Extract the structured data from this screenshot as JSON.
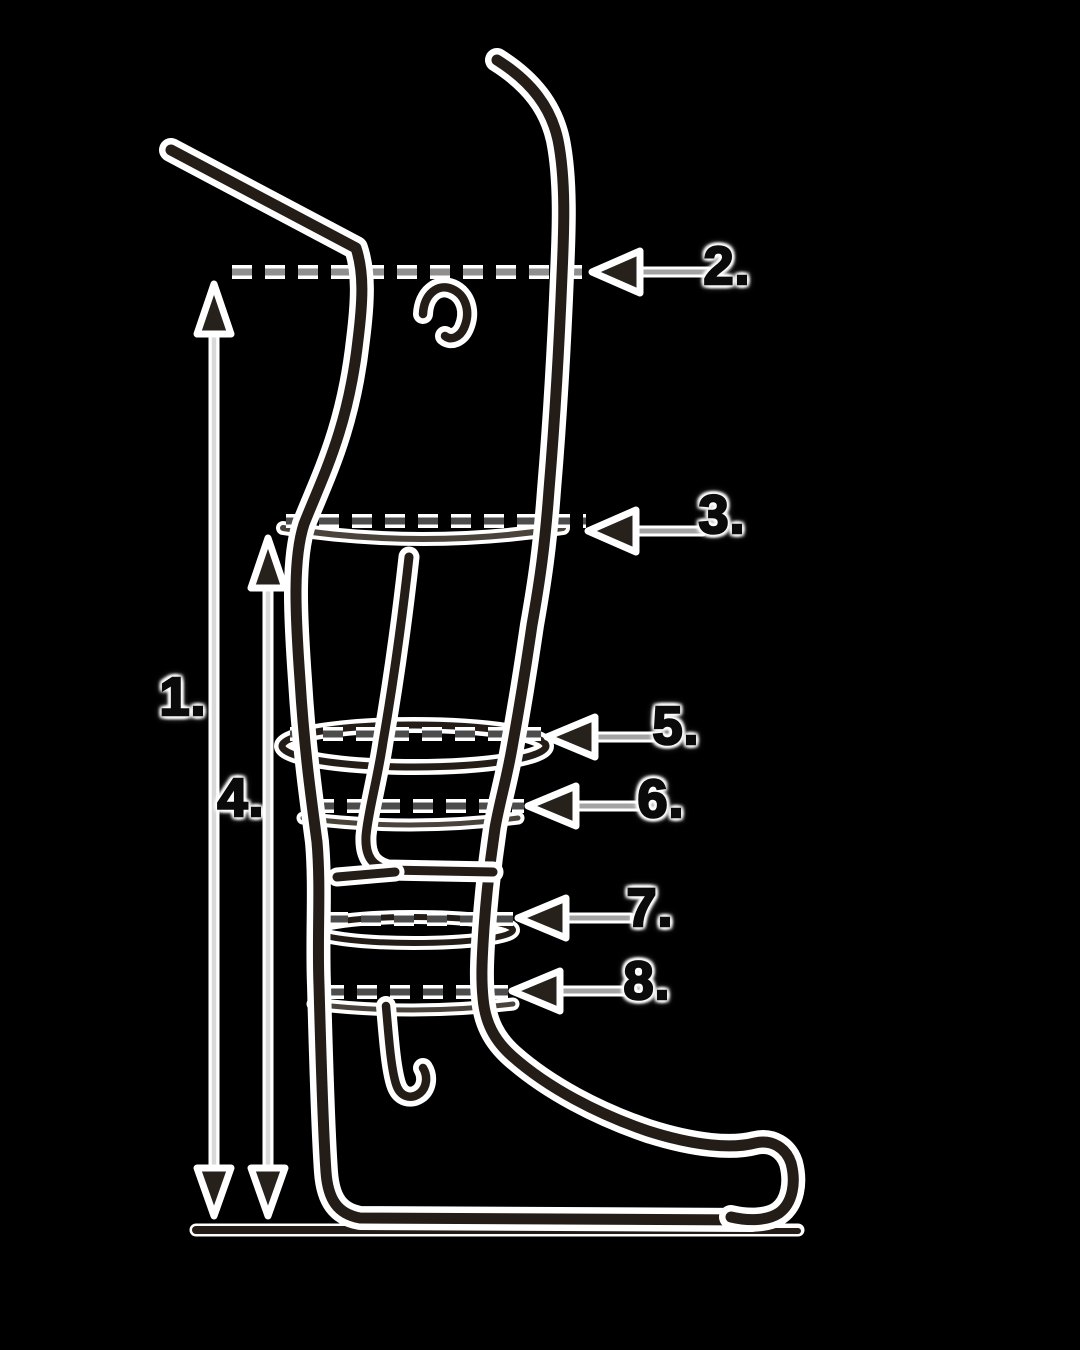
{
  "diagram": {
    "background_color": "#000000",
    "ink_color": "#241c16",
    "halo_color": "#ffffff",
    "measure_line_color": "#d9d9d9",
    "arrow_shaft_color": "#a3a3a3",
    "label_color": "#0a0a0a"
  },
  "labels": [
    {
      "text": "1."
    },
    {
      "text": "2."
    },
    {
      "text": "3."
    },
    {
      "text": "4."
    },
    {
      "text": "5."
    },
    {
      "text": "6."
    },
    {
      "text": "7."
    },
    {
      "text": "8."
    }
  ]
}
